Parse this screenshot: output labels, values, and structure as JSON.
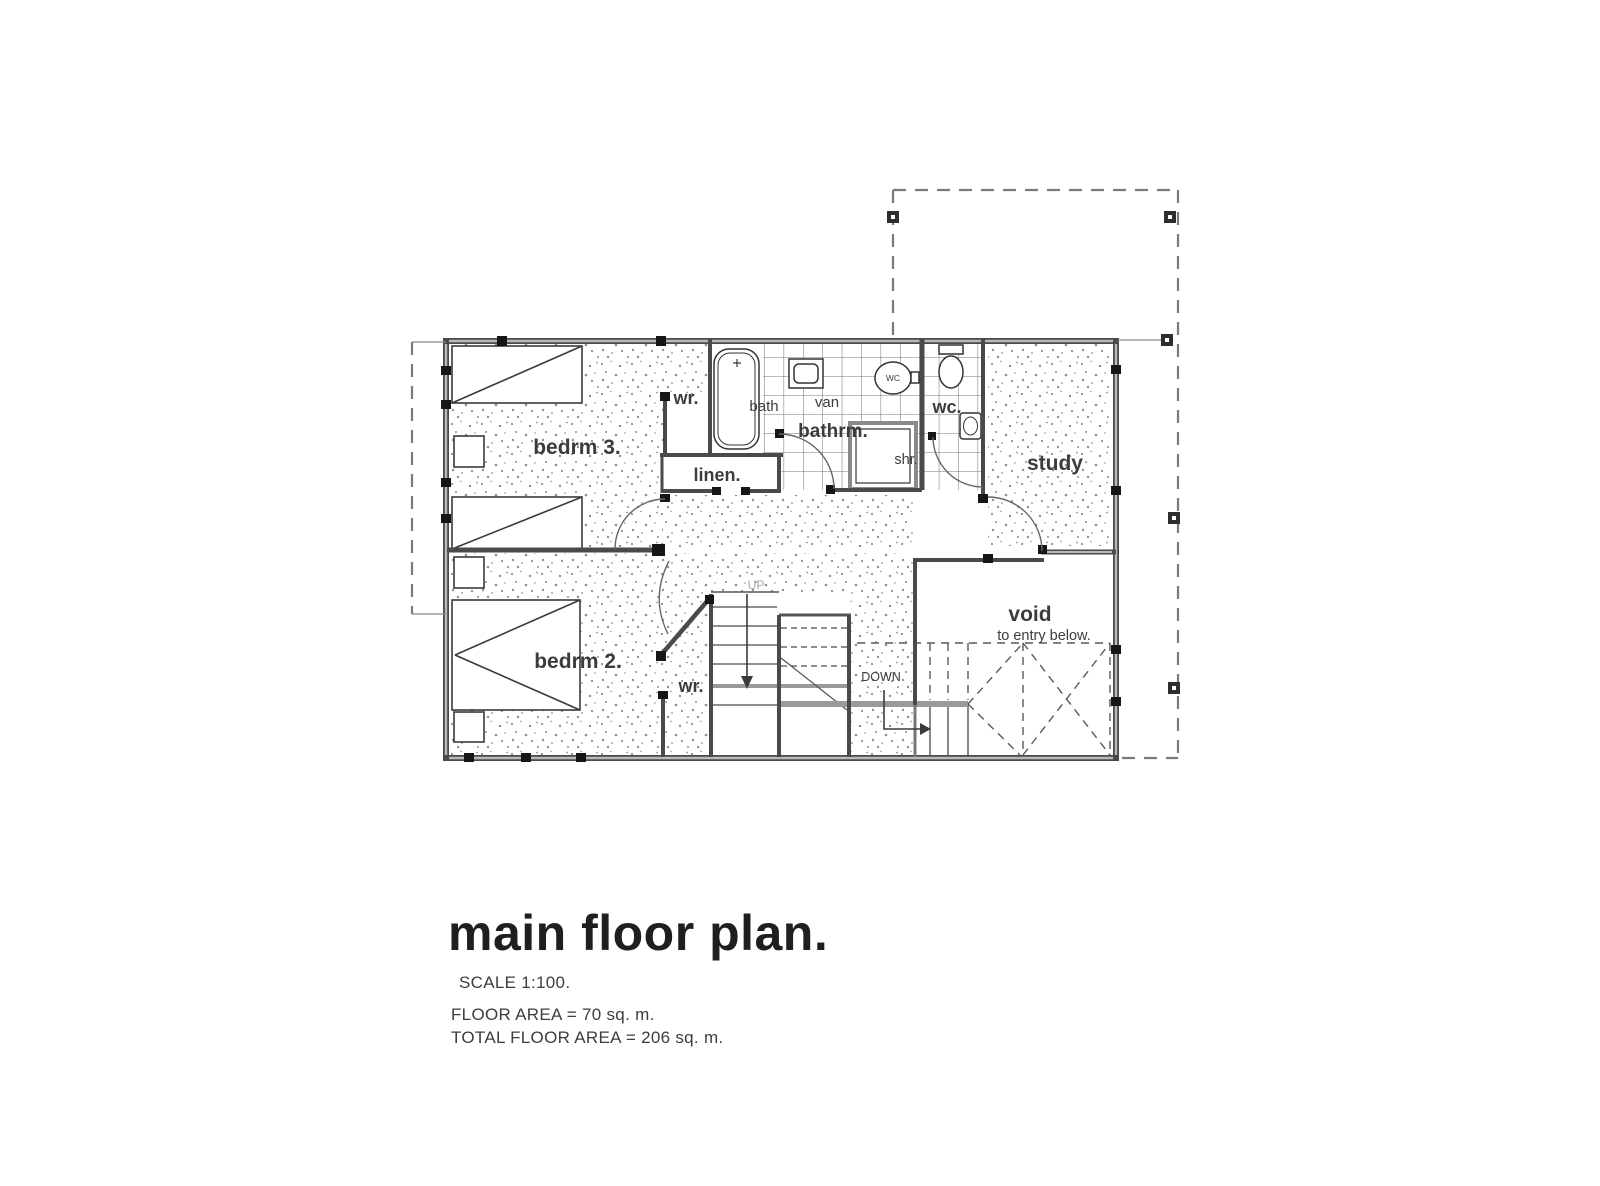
{
  "document": {
    "type": "architectural floor plan drawing",
    "sheet_background": "#ffffff"
  },
  "labels": {
    "bedrm3": "bedrm 3.",
    "bedrm2": "bedrm 2.",
    "wr_top": "wr.",
    "wr_bottom": "wr.",
    "linen": "linen.",
    "bath": "bath",
    "van": "van",
    "bathrm": "bathrm.",
    "shr": "shr.",
    "wc_fixture": "WC",
    "wc_room": "wc.",
    "study": "study",
    "void": "void",
    "void_sub": "to entry below.",
    "up": "UP",
    "down": "DOWN"
  },
  "title_block": {
    "title": "main floor plan.",
    "scale": "SCALE 1:100.",
    "floor_area": "FLOOR AREA = 70 sq. m.",
    "total_floor_area": "TOTAL FLOOR AREA = 206 sq. m."
  },
  "colors": {
    "wall": "#4a4a4a",
    "wall_core": "#b9b9b9",
    "stipple_dot": "#8f8f8f",
    "dashed_boundary": "#7a7a7a",
    "stair_gray": "#9a9a9a",
    "label_dark": "#3c3c3c",
    "label_blue": "#6e7e9b",
    "label_gray": "#8e99a8",
    "label_faint": "#a6a6a6"
  }
}
